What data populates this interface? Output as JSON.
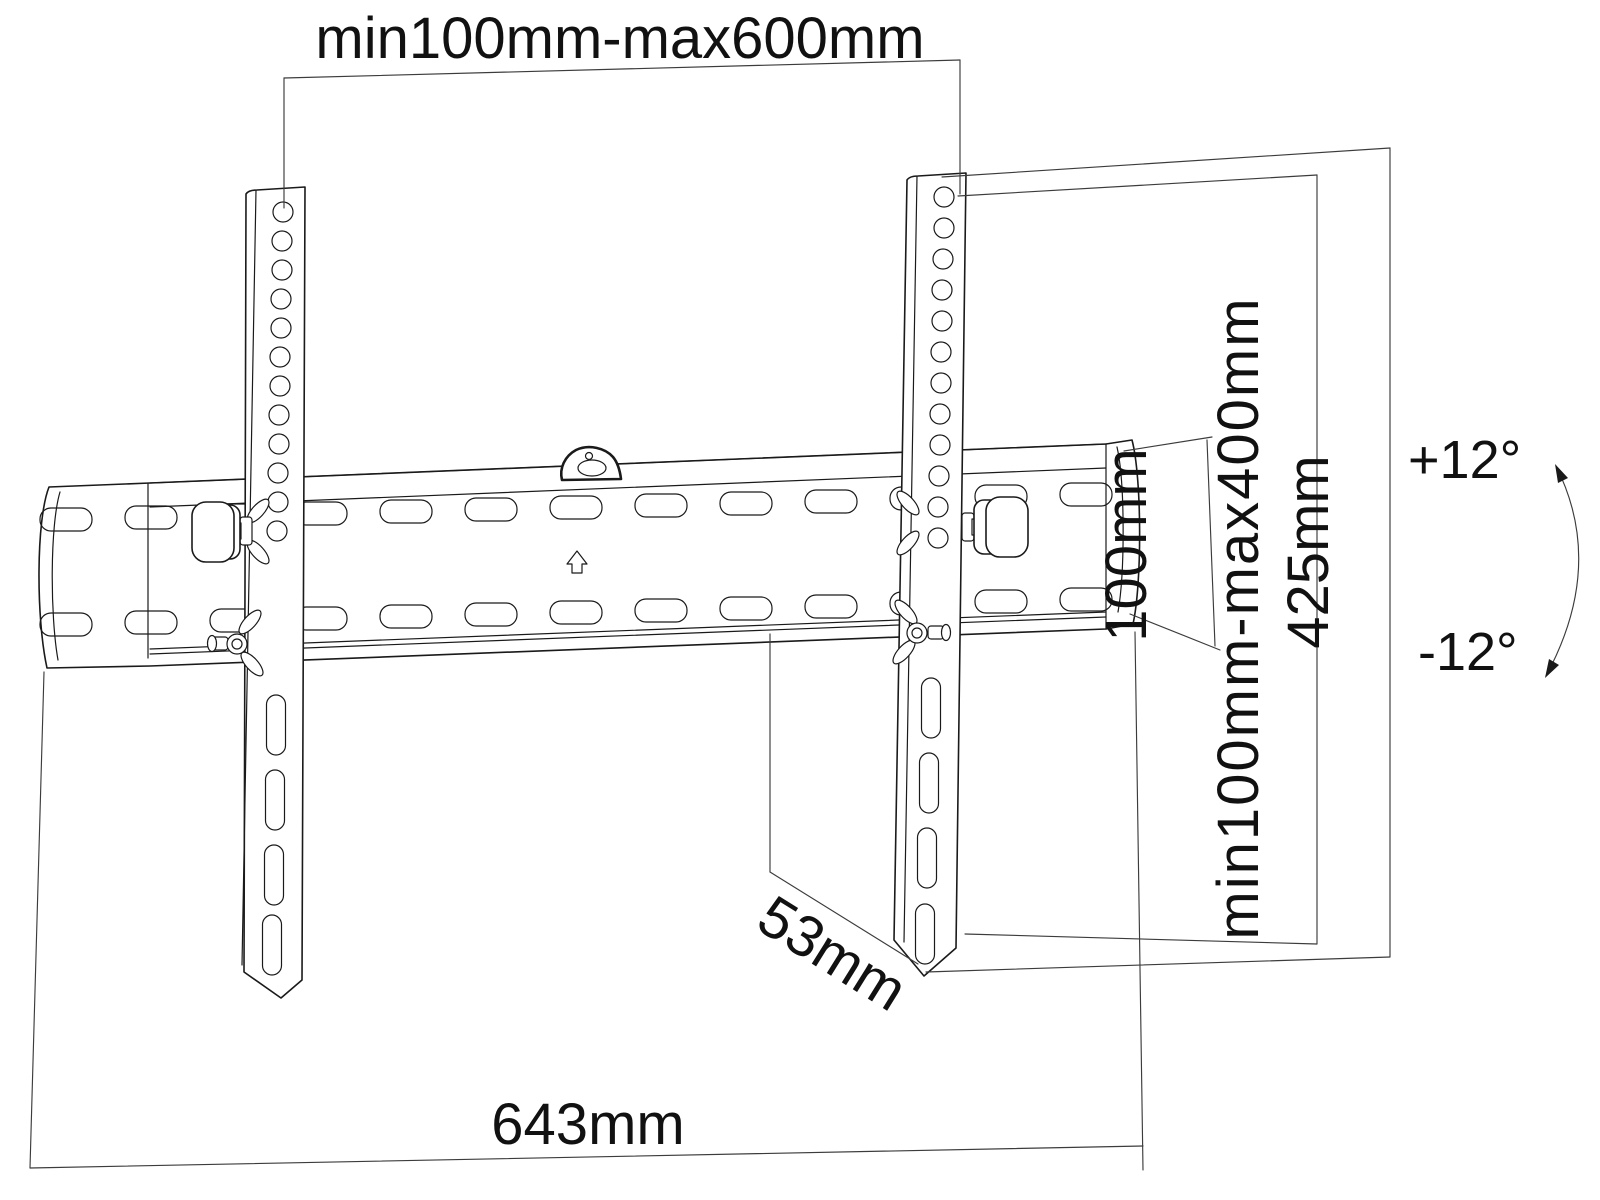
{
  "drawing": {
    "title": "Tilting TV wall mount bracket — dimensional drawing",
    "background_color": "#ffffff",
    "line_color": "#1a1a1a",
    "labels": {
      "top_width_range": "min100mm-max600mm",
      "right_end_height": "100mm",
      "vesa_vertical_range": "min100mm-max400mm",
      "bracket_total_height": "425mm",
      "tilt_up_angle": "+12°",
      "tilt_down_angle": "-12°",
      "wall_distance": "53mm",
      "plate_total_width": "643mm"
    }
  }
}
